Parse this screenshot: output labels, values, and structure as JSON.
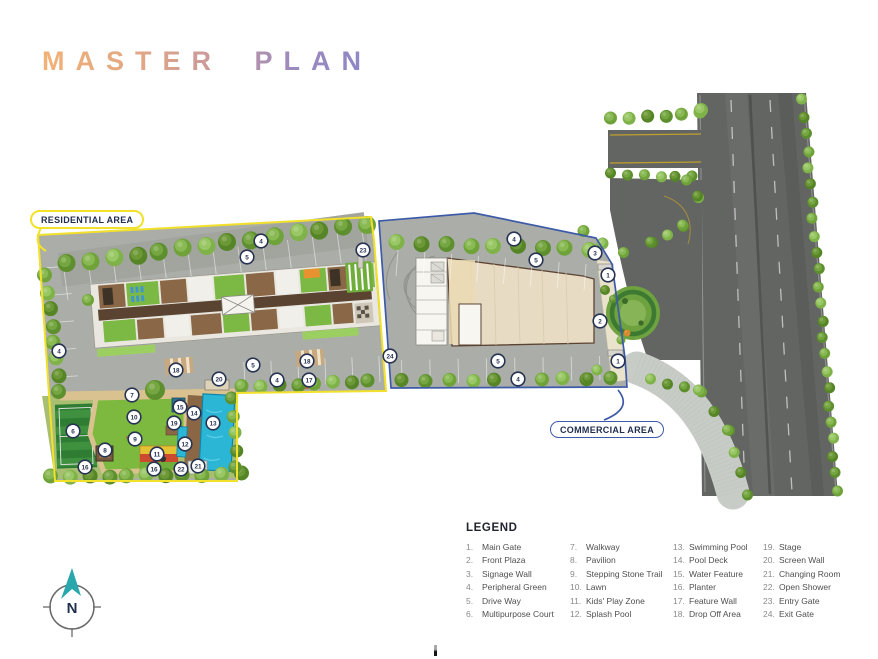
{
  "title": "MASTER PLAN",
  "labels": {
    "residential": "RESIDENTIAL AREA",
    "commercial": "COMMERCIAL AREA"
  },
  "compass": {
    "letter": "N"
  },
  "legend": {
    "title": "LEGEND",
    "items": [
      {
        "num": "1.",
        "label": "Main Gate"
      },
      {
        "num": "2.",
        "label": "Front Plaza"
      },
      {
        "num": "3.",
        "label": "Signage Wall"
      },
      {
        "num": "4.",
        "label": "Peripheral Green"
      },
      {
        "num": "5.",
        "label": "Drive Way"
      },
      {
        "num": "6.",
        "label": "Multipurpose Court"
      },
      {
        "num": "7.",
        "label": "Walkway"
      },
      {
        "num": "8.",
        "label": "Pavilion"
      },
      {
        "num": "9.",
        "label": "Stepping Stone Trail"
      },
      {
        "num": "10.",
        "label": "Lawn"
      },
      {
        "num": "11.",
        "label": "Kids' Play Zone"
      },
      {
        "num": "12.",
        "label": "Splash Pool"
      },
      {
        "num": "13.",
        "label": "Swimming Pool"
      },
      {
        "num": "14.",
        "label": "Pool Deck"
      },
      {
        "num": "15.",
        "label": "Water Feature"
      },
      {
        "num": "16.",
        "label": "Planter"
      },
      {
        "num": "17.",
        "label": "Feature Wall"
      },
      {
        "num": "18.",
        "label": "Drop Off Area"
      },
      {
        "num": "19.",
        "label": "Stage"
      },
      {
        "num": "20.",
        "label": "Screen Wall"
      },
      {
        "num": "21.",
        "label": "Changing Room"
      },
      {
        "num": "22.",
        "label": "Open Shower"
      },
      {
        "num": "23.",
        "label": "Entry Gate"
      },
      {
        "num": "24.",
        "label": "Exit Gate"
      }
    ]
  },
  "markers": [
    {
      "n": "4",
      "x": 261,
      "y": 241
    },
    {
      "n": "5",
      "x": 247,
      "y": 257
    },
    {
      "n": "23",
      "x": 363,
      "y": 250
    },
    {
      "n": "4",
      "x": 59,
      "y": 351
    },
    {
      "n": "18",
      "x": 176,
      "y": 370
    },
    {
      "n": "20",
      "x": 219,
      "y": 379
    },
    {
      "n": "5",
      "x": 253,
      "y": 365
    },
    {
      "n": "18",
      "x": 307,
      "y": 361
    },
    {
      "n": "17",
      "x": 309,
      "y": 380
    },
    {
      "n": "4",
      "x": 277,
      "y": 380
    },
    {
      "n": "24",
      "x": 390,
      "y": 356
    },
    {
      "n": "7",
      "x": 132,
      "y": 395
    },
    {
      "n": "6",
      "x": 73,
      "y": 431
    },
    {
      "n": "10",
      "x": 134,
      "y": 417
    },
    {
      "n": "8",
      "x": 105,
      "y": 450
    },
    {
      "n": "9",
      "x": 135,
      "y": 439
    },
    {
      "n": "11",
      "x": 157,
      "y": 454
    },
    {
      "n": "16",
      "x": 85,
      "y": 467
    },
    {
      "n": "16",
      "x": 154,
      "y": 469
    },
    {
      "n": "15",
      "x": 180,
      "y": 407
    },
    {
      "n": "14",
      "x": 194,
      "y": 413
    },
    {
      "n": "19",
      "x": 174,
      "y": 423
    },
    {
      "n": "13",
      "x": 213,
      "y": 423
    },
    {
      "n": "12",
      "x": 185,
      "y": 444
    },
    {
      "n": "22",
      "x": 181,
      "y": 469
    },
    {
      "n": "21",
      "x": 198,
      "y": 466
    },
    {
      "n": "4",
      "x": 514,
      "y": 239
    },
    {
      "n": "5",
      "x": 536,
      "y": 260
    },
    {
      "n": "3",
      "x": 595,
      "y": 253
    },
    {
      "n": "1",
      "x": 608,
      "y": 275
    },
    {
      "n": "2",
      "x": 600,
      "y": 321
    },
    {
      "n": "1",
      "x": 618,
      "y": 361
    },
    {
      "n": "5",
      "x": 498,
      "y": 361
    },
    {
      "n": "4",
      "x": 518,
      "y": 379
    }
  ],
  "trees": {
    "rows": [
      {
        "x1": 68,
        "y1": 264,
        "x2": 366,
        "y2": 224,
        "n": 14,
        "r": 9
      },
      {
        "x1": 398,
        "y1": 243,
        "x2": 590,
        "y2": 249,
        "n": 9,
        "r": 8
      },
      {
        "x1": 403,
        "y1": 381,
        "x2": 610,
        "y2": 378,
        "n": 10,
        "r": 7
      },
      {
        "x1": 243,
        "y1": 387,
        "x2": 369,
        "y2": 381,
        "n": 8,
        "r": 7
      },
      {
        "x1": 46,
        "y1": 276,
        "x2": 60,
        "y2": 392,
        "n": 8,
        "r": 7.5
      },
      {
        "x1": 52,
        "y1": 477,
        "x2": 240,
        "y2": 474,
        "n": 11,
        "r": 7.5
      },
      {
        "x1": 233,
        "y1": 399,
        "x2": 236,
        "y2": 467,
        "n": 5,
        "r": 6.5
      },
      {
        "x1": 612,
        "y1": 119,
        "x2": 700,
        "y2": 113,
        "n": 6,
        "r": 6.5
      },
      {
        "x1": 612,
        "y1": 174,
        "x2": 692,
        "y2": 177,
        "n": 6,
        "r": 5.5
      },
      {
        "x1": 688,
        "y1": 181,
        "x2": 699,
        "y2": 197,
        "n": 2,
        "r": 5.5
      },
      {
        "x1": 699,
        "y1": 197,
        "x2": 684,
        "y2": 226,
        "n": 2,
        "r": 5.5
      },
      {
        "x1": 684,
        "y1": 226,
        "x2": 652,
        "y2": 243,
        "n": 3,
        "r": 5.5
      },
      {
        "x1": 652,
        "y1": 243,
        "x2": 624,
        "y2": 252,
        "n": 2,
        "r": 5.5
      },
      {
        "x1": 803,
        "y1": 100,
        "x2": 837,
        "y2": 490,
        "n": 24,
        "r": 5.5
      },
      {
        "x1": 652,
        "y1": 380,
        "x2": 700,
        "y2": 391,
        "n": 4,
        "r": 5.5
      },
      {
        "x1": 700,
        "y1": 391,
        "x2": 729,
        "y2": 431,
        "n": 3,
        "r": 5.5
      },
      {
        "x1": 729,
        "y1": 431,
        "x2": 746,
        "y2": 494,
        "n": 4,
        "r": 5.5
      },
      {
        "x1": 585,
        "y1": 232,
        "x2": 603,
        "y2": 243,
        "n": 2,
        "r": 6
      }
    ],
    "singles": [
      {
        "x": 701,
        "y": 110,
        "r": 7
      },
      {
        "x": 605,
        "y": 290,
        "r": 5
      },
      {
        "x": 613,
        "y": 299,
        "r": 4
      },
      {
        "x": 621,
        "y": 340,
        "r": 4.5
      },
      {
        "x": 597,
        "y": 370,
        "r": 5.5
      },
      {
        "x": 588,
        "y": 378,
        "r": 5.5
      },
      {
        "x": 155,
        "y": 390,
        "r": 10
      },
      {
        "x": 88,
        "y": 300,
        "r": 6
      },
      {
        "x": 627,
        "y": 333,
        "r": 3.5,
        "c": "#d98a2e"
      }
    ]
  },
  "colors": {
    "boundary_residential": "#f2e12b",
    "boundary_commercial": "#3d5aa9",
    "marker_stroke": "#273352",
    "road": "#626562",
    "pool": "#2cb6d6",
    "lawn": "#7cb93e",
    "compass_arrow": "#2aa7ac",
    "title_gradient": [
      "#f3b176",
      "#c6989f",
      "#8d86c8"
    ]
  }
}
